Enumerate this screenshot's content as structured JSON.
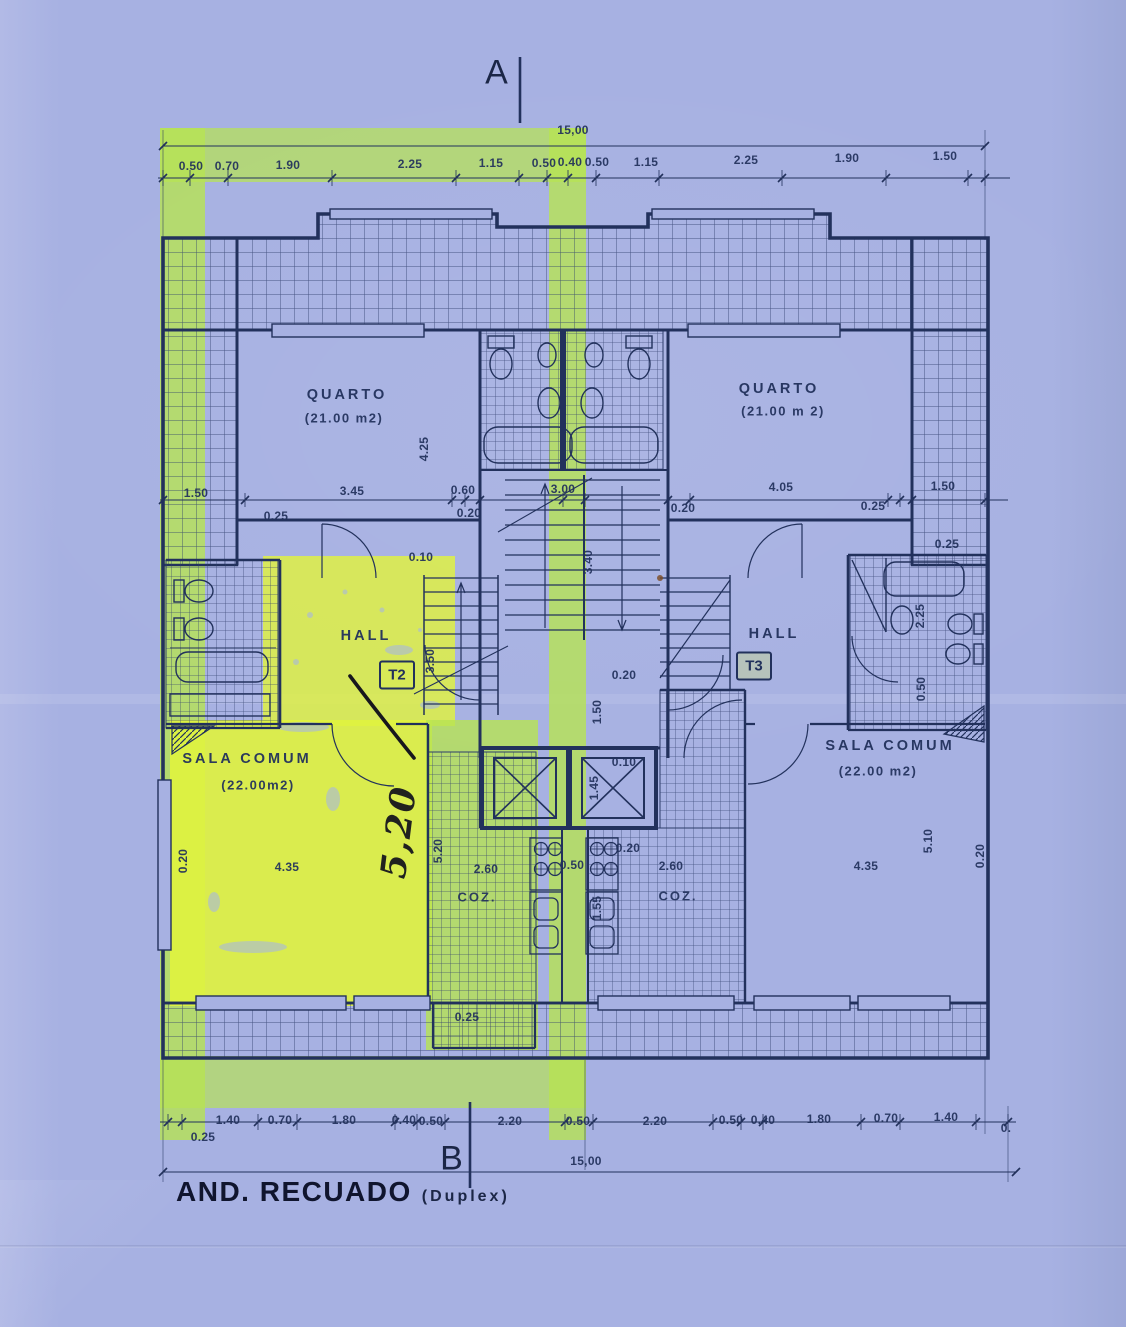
{
  "document": {
    "title": "AND. RECUADO",
    "subtitle": "(Duplex)",
    "section_marker_top": "A",
    "section_marker_bottom": "B",
    "overall_width_top": "15,00",
    "overall_width_bottom": "15,00"
  },
  "plan": {
    "units": [
      {
        "code": "T2",
        "hall": "HALL",
        "bedroom": "QUARTO",
        "bedroom_area": "(21.00 m2)",
        "living": "SALA COMUM",
        "living_area": "(22.00m2)",
        "kitchen": "COZ.",
        "highlighted": true
      },
      {
        "code": "T3",
        "hall": "HALL",
        "bedroom": "QUARTO",
        "bedroom_area": "(21.00 m 2)",
        "living": "SALA COMUM",
        "living_area": "(22.00 m2)",
        "kitchen": "COZ.",
        "highlighted": false
      }
    ],
    "annotations": {
      "handwritten_dimension": "5,20"
    }
  },
  "dimensions": {
    "top_chain": [
      "0.50",
      "0.70",
      "1.90",
      "2.25",
      "1.15",
      "0.50",
      "0.40",
      "0.50",
      "1.15",
      "2.25",
      "1.90",
      "1.50"
    ],
    "middle_chain": [
      "1.50",
      "0.25",
      "3.45",
      "0.60",
      "0.20",
      "3.00",
      "0.20",
      "4.05",
      "0.25",
      "1.50",
      "0.25",
      "0.10"
    ],
    "bottom_chain": [
      "0.25",
      "1.40",
      "0.70",
      "1.80",
      "0.40",
      "0.50",
      "2.20",
      "0.50",
      "2.20",
      "0.50",
      "0.40",
      "1.80",
      "0.70",
      "1.40",
      "0."
    ],
    "vertical_dims": [
      "4.25",
      "3.40",
      "3.50",
      "1.50",
      "2.25",
      "0.50",
      "1.45",
      "1.55",
      "5.20",
      "5.10",
      "0.20",
      "0.20"
    ],
    "interior_dims": [
      "0.10",
      "0.10",
      "0.20",
      "0.20",
      "0.50",
      "2.60",
      "2.60",
      "4.35",
      "4.35",
      "0.25"
    ]
  },
  "colors": {
    "paper": "#a7b1e2",
    "ink": "#22315c",
    "pen": "#17171d",
    "highlighter": "#b7e353",
    "highlighterBright": "#e0f33e"
  },
  "labels": [
    {
      "text": "15,00",
      "x": 573,
      "y": 130,
      "cls": "dim"
    },
    {
      "text": "0.50",
      "x": 191,
      "y": 166,
      "cls": "dim"
    },
    {
      "text": "0.70",
      "x": 227,
      "y": 166,
      "cls": "dim"
    },
    {
      "text": "1.90",
      "x": 288,
      "y": 165,
      "cls": "dim"
    },
    {
      "text": "2.25",
      "x": 410,
      "y": 164,
      "cls": "dim"
    },
    {
      "text": "1.15",
      "x": 491,
      "y": 163,
      "cls": "dim"
    },
    {
      "text": "0.50",
      "x": 544,
      "y": 163,
      "cls": "dim"
    },
    {
      "text": "0.40",
      "x": 570,
      "y": 162,
      "cls": "dim"
    },
    {
      "text": "0.50",
      "x": 597,
      "y": 162,
      "cls": "dim"
    },
    {
      "text": "1.15",
      "x": 646,
      "y": 162,
      "cls": "dim"
    },
    {
      "text": "2.25",
      "x": 746,
      "y": 160,
      "cls": "dim"
    },
    {
      "text": "1.90",
      "x": 847,
      "y": 158,
      "cls": "dim"
    },
    {
      "text": "1.50",
      "x": 945,
      "y": 156,
      "cls": "dim"
    },
    {
      "text": "QUARTO",
      "x": 347,
      "y": 395,
      "cls": "room"
    },
    {
      "text": "(21.00 m2)",
      "x": 344,
      "y": 418,
      "cls": "roomsub"
    },
    {
      "text": "QUARTO",
      "x": 779,
      "y": 389,
      "cls": "room"
    },
    {
      "text": "(21.00 m 2)",
      "x": 783,
      "y": 411,
      "cls": "roomsub"
    },
    {
      "text": "4.25",
      "x": 424,
      "y": 449,
      "rot": -90,
      "cls": "dim"
    },
    {
      "text": "1.50",
      "x": 196,
      "y": 493,
      "cls": "dim"
    },
    {
      "text": "3.45",
      "x": 352,
      "y": 491,
      "cls": "dim"
    },
    {
      "text": "0.60",
      "x": 463,
      "y": 490,
      "cls": "dim"
    },
    {
      "text": "3.00",
      "x": 563,
      "y": 489,
      "cls": "dim"
    },
    {
      "text": "4.05",
      "x": 781,
      "y": 487,
      "cls": "dim"
    },
    {
      "text": "1.50",
      "x": 943,
      "y": 486,
      "cls": "dim"
    },
    {
      "text": "0.25",
      "x": 276,
      "y": 516,
      "cls": "dim"
    },
    {
      "text": "0.20",
      "x": 469,
      "y": 513,
      "cls": "dim"
    },
    {
      "text": "0.20",
      "x": 683,
      "y": 508,
      "cls": "dim"
    },
    {
      "text": "0.25",
      "x": 873,
      "y": 506,
      "cls": "dim"
    },
    {
      "text": "0.25",
      "x": 947,
      "y": 544,
      "cls": "dim"
    },
    {
      "text": "0.10",
      "x": 421,
      "y": 557,
      "cls": "dim"
    },
    {
      "text": "3.40",
      "x": 588,
      "y": 562,
      "rot": -90,
      "cls": "dim"
    },
    {
      "text": "HALL",
      "x": 366,
      "y": 636,
      "cls": "room"
    },
    {
      "text": "HALL",
      "x": 774,
      "y": 634,
      "cls": "room"
    },
    {
      "text": "3.50",
      "x": 430,
      "y": 661,
      "rot": -90,
      "cls": "dim"
    },
    {
      "text": "0.20",
      "x": 624,
      "y": 675,
      "cls": "dim"
    },
    {
      "text": "1.50",
      "x": 597,
      "y": 712,
      "rot": -90,
      "cls": "dim"
    },
    {
      "text": "2.25",
      "x": 920,
      "y": 616,
      "rot": -90,
      "cls": "dim"
    },
    {
      "text": "0.50",
      "x": 921,
      "y": 689,
      "rot": -90,
      "cls": "dim"
    },
    {
      "text": "SALA COMUM",
      "x": 247,
      "y": 759,
      "cls": "room"
    },
    {
      "text": "(22.00m2)",
      "x": 258,
      "y": 785,
      "cls": "roomsub"
    },
    {
      "text": "SALA COMUM",
      "x": 890,
      "y": 746,
      "cls": "room"
    },
    {
      "text": "(22.00 m2)",
      "x": 878,
      "y": 771,
      "cls": "roomsub"
    },
    {
      "text": "0.10",
      "x": 624,
      "y": 762,
      "cls": "dim"
    },
    {
      "text": "1.45",
      "x": 594,
      "y": 788,
      "rot": -90,
      "cls": "dim"
    },
    {
      "text": "0.20",
      "x": 183,
      "y": 861,
      "rot": -90,
      "cls": "dim"
    },
    {
      "text": "4.35",
      "x": 287,
      "y": 867,
      "cls": "dim"
    },
    {
      "text": "5.20",
      "x": 438,
      "y": 851,
      "rot": -90,
      "cls": "dim"
    },
    {
      "text": "2.60",
      "x": 486,
      "y": 869,
      "cls": "dim"
    },
    {
      "text": "0.50",
      "x": 572,
      "y": 865,
      "cls": "dim"
    },
    {
      "text": "0.20",
      "x": 628,
      "y": 848,
      "cls": "dim"
    },
    {
      "text": "2.60",
      "x": 671,
      "y": 866,
      "cls": "dim"
    },
    {
      "text": "COZ.",
      "x": 477,
      "y": 897,
      "cls": "room2"
    },
    {
      "text": "COZ.",
      "x": 678,
      "y": 896,
      "cls": "room2"
    },
    {
      "text": "1.55",
      "x": 597,
      "y": 908,
      "rot": -90,
      "cls": "dim"
    },
    {
      "text": "5.10",
      "x": 928,
      "y": 841,
      "rot": -90,
      "cls": "dim"
    },
    {
      "text": "0.20",
      "x": 980,
      "y": 856,
      "rot": -90,
      "cls": "dim"
    },
    {
      "text": "4.35",
      "x": 866,
      "y": 866,
      "cls": "dim"
    },
    {
      "text": "0.25",
      "x": 467,
      "y": 1017,
      "cls": "dim"
    },
    {
      "text": "0.25",
      "x": 203,
      "y": 1137,
      "cls": "dim"
    },
    {
      "text": "1.40",
      "x": 228,
      "y": 1120,
      "cls": "dim"
    },
    {
      "text": "0.70",
      "x": 280,
      "y": 1120,
      "cls": "dim"
    },
    {
      "text": "1.80",
      "x": 344,
      "y": 1120,
      "cls": "dim"
    },
    {
      "text": "0.40",
      "x": 404,
      "y": 1120,
      "cls": "dim"
    },
    {
      "text": "0.50",
      "x": 431,
      "y": 1121,
      "cls": "dim"
    },
    {
      "text": "2.20",
      "x": 510,
      "y": 1121,
      "cls": "dim"
    },
    {
      "text": "0.50",
      "x": 578,
      "y": 1121,
      "cls": "dim"
    },
    {
      "text": "2.20",
      "x": 655,
      "y": 1121,
      "cls": "dim"
    },
    {
      "text": "0.50",
      "x": 731,
      "y": 1120,
      "cls": "dim"
    },
    {
      "text": "0.40",
      "x": 763,
      "y": 1120,
      "cls": "dim"
    },
    {
      "text": "1.80",
      "x": 819,
      "y": 1119,
      "cls": "dim"
    },
    {
      "text": "0.70",
      "x": 886,
      "y": 1118,
      "cls": "dim"
    },
    {
      "text": "1.40",
      "x": 946,
      "y": 1117,
      "cls": "dim"
    },
    {
      "text": "0.",
      "x": 1006,
      "y": 1128,
      "cls": "dim"
    },
    {
      "text": "15,00",
      "x": 586,
      "y": 1161,
      "cls": "dim"
    },
    {
      "text": "5,20",
      "x": 399,
      "y": 832,
      "rot": -83,
      "cls": "pen"
    }
  ]
}
